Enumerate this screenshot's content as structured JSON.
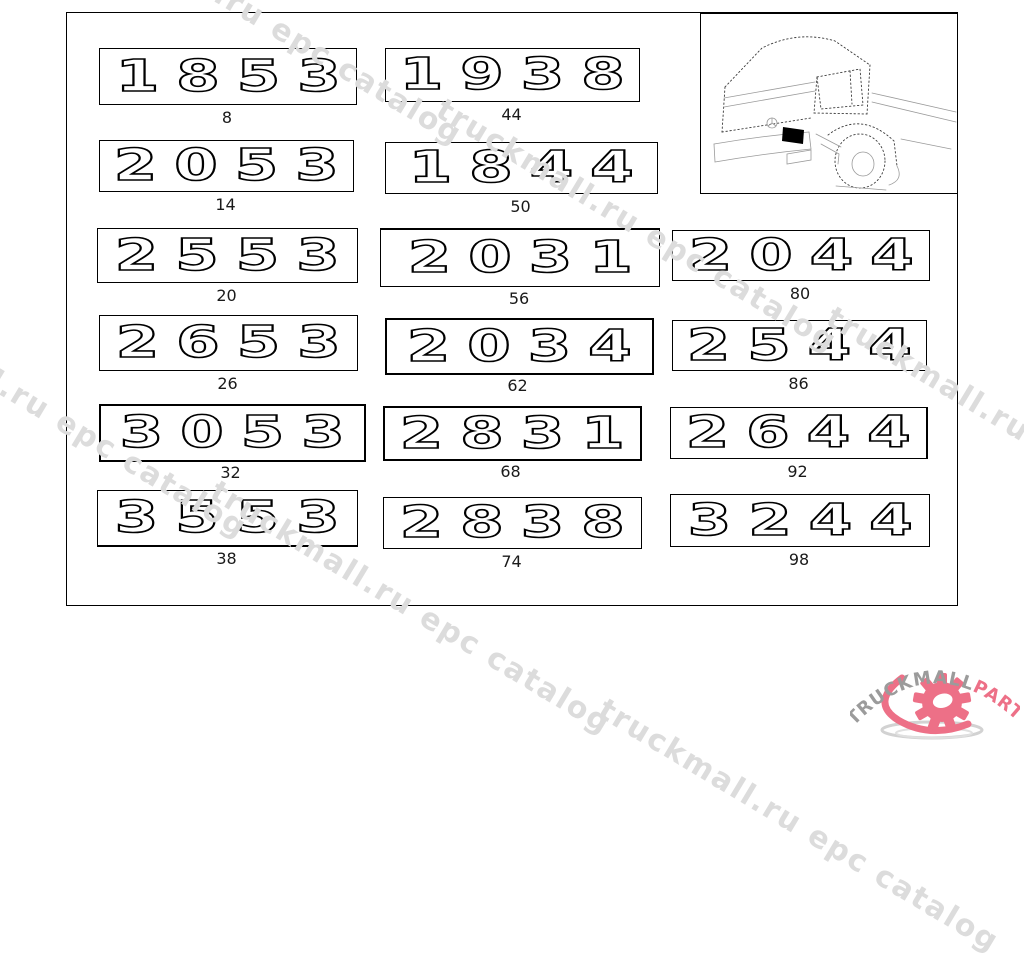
{
  "watermark": {
    "text": "truckmall.ru epc catalog",
    "color": "#dcdcdc"
  },
  "badges": [
    {
      "model": "1853",
      "ref": "8"
    },
    {
      "model": "2053",
      "ref": "14"
    },
    {
      "model": "2553",
      "ref": "20"
    },
    {
      "model": "2653",
      "ref": "26"
    },
    {
      "model": "3053",
      "ref": "32"
    },
    {
      "model": "3553",
      "ref": "38"
    },
    {
      "model": "1938",
      "ref": "44"
    },
    {
      "model": "1844",
      "ref": "50"
    },
    {
      "model": "2031",
      "ref": "56"
    },
    {
      "model": "2034",
      "ref": "62"
    },
    {
      "model": "2831",
      "ref": "68"
    },
    {
      "model": "2838",
      "ref": "74"
    },
    {
      "model": "2044",
      "ref": "80"
    },
    {
      "model": "2544",
      "ref": "86"
    },
    {
      "model": "2644",
      "ref": "92"
    },
    {
      "model": "3244",
      "ref": "98"
    }
  ],
  "logo": {
    "brand_gray": "TRUCKMALL",
    "brand_pink": "PARTS",
    "gray_color": "#9b9b9b",
    "pink_color": "#ed7087"
  }
}
